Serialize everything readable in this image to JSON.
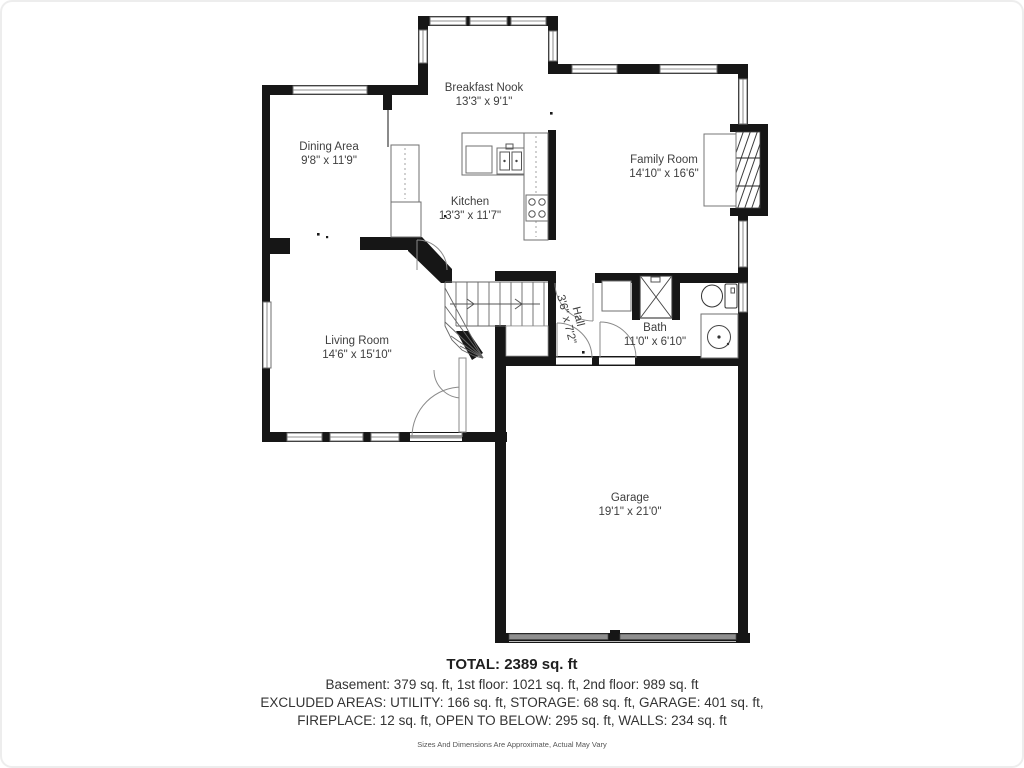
{
  "floor_plan": {
    "rooms": [
      {
        "id": "breakfast-nook",
        "name": "Breakfast Nook",
        "dims": "13'3\" x 9'1\""
      },
      {
        "id": "dining-area",
        "name": "Dining Area",
        "dims": "9'8\" x 11'9\""
      },
      {
        "id": "kitchen",
        "name": "Kitchen",
        "dims": "13'3\" x 11'7\""
      },
      {
        "id": "family-room",
        "name": "Family Room",
        "dims": "14'10\" x 16'6\""
      },
      {
        "id": "living-room",
        "name": "Living Room",
        "dims": "14'6\" x 15'10\""
      },
      {
        "id": "hall",
        "name": "Hall",
        "dims": "3'6\" x 7'2\""
      },
      {
        "id": "bath",
        "name": "Bath",
        "dims": "11'0\" x 6'10\""
      },
      {
        "id": "garage",
        "name": "Garage",
        "dims": "19'1\" x 21'0\""
      }
    ],
    "fixtures": [
      "stairs",
      "fireplace",
      "kitchen-sink",
      "cooktop",
      "refrigerator",
      "pantry",
      "shower",
      "toilet",
      "vanity-sink",
      "garage-doors",
      "entry-door"
    ],
    "colors": {
      "wall": "#161616",
      "label": "#3f3f3f",
      "fixture_line": "#6f6f6f",
      "garage_door": "#8f8f8f"
    }
  },
  "summary": {
    "total": "TOTAL: 2389 sq. ft",
    "floors": "Basement: 379 sq. ft, 1st floor: 1021 sq. ft, 2nd floor: 989 sq. ft",
    "excluded_1": "EXCLUDED AREAS: UTILITY: 166 sq. ft, STORAGE: 68 sq. ft, GARAGE: 401 sq. ft,",
    "excluded_2": "FIREPLACE: 12 sq. ft, OPEN TO BELOW: 295 sq. ft, WALLS: 234 sq. ft",
    "disclaimer": "Sizes And Dimensions Are Approximate, Actual May Vary"
  }
}
